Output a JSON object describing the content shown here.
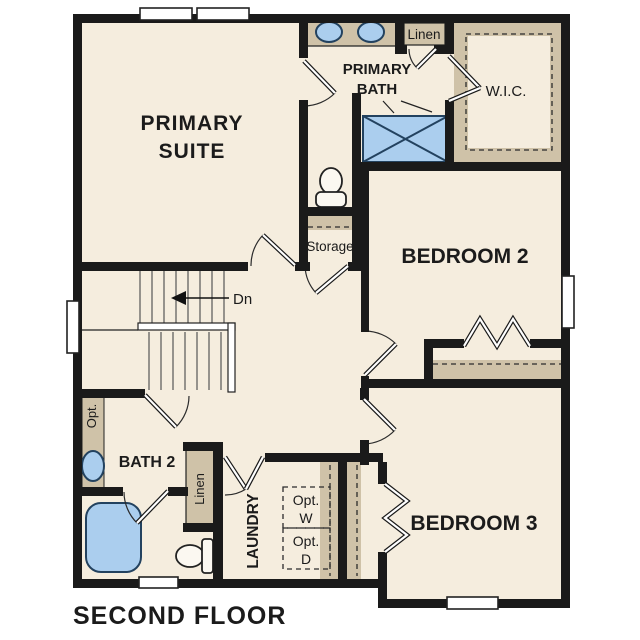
{
  "floor_title": "SECOND FLOOR",
  "rooms": {
    "primary_suite": {
      "line1": "PRIMARY",
      "line2": "SUITE"
    },
    "primary_bath": {
      "line1": "PRIMARY",
      "line2": "BATH"
    },
    "wic": {
      "label": "W.I.C."
    },
    "bedroom_2": {
      "label": "BEDROOM 2"
    },
    "bedroom_3": {
      "label": "BEDROOM 3"
    },
    "bath_2": {
      "label": "BATH 2"
    },
    "laundry": {
      "label": "LAUNDRY"
    }
  },
  "closets": {
    "linen_top": {
      "label": "Linen"
    },
    "linen_hall": {
      "label": "Linen"
    },
    "storage": {
      "label": "Storage"
    }
  },
  "stairs": {
    "direction_label": "Dn"
  },
  "optional_fixtures": {
    "washer": {
      "line1": "Opt.",
      "line2": "W"
    },
    "dryer": {
      "line1": "Opt.",
      "line2": "D"
    },
    "bath2_vanity": {
      "label": "Opt."
    }
  },
  "colors": {
    "wall": "#1a1a1a",
    "floor_cream": "#f5edde",
    "counter_tan": "#cfc2a8",
    "fixture_blue": "#abceee",
    "optional_gray": "#e5e5e5",
    "background": "#ffffff"
  }
}
